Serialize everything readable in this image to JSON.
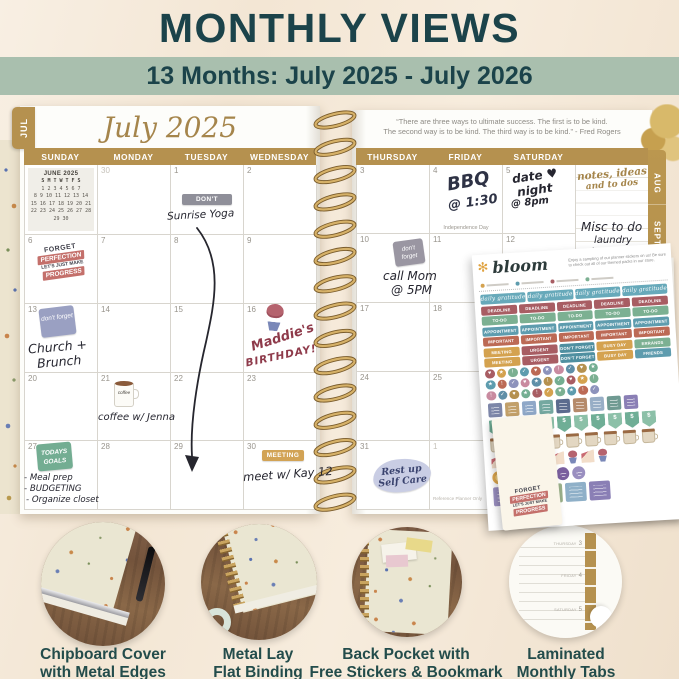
{
  "header": {
    "title": "MONTHLY VIEWS",
    "banner": "13 Months: July 2025 - July 2026"
  },
  "colors": {
    "heading_teal": "#1b434a",
    "banner_green": "#a9bfae",
    "planner_gold": "#b5914f"
  },
  "planner": {
    "month_tab": "JUL",
    "month_title": "July 2025",
    "quote_line1": "“There are three ways to ultimate success. The first is to be kind.",
    "quote_line2": "The second way is to be kind. The third way is to be kind.” - Fred Rogers",
    "weekdays_left": [
      "SUNDAY",
      "MONDAY",
      "TUESDAY",
      "WEDNESDAY"
    ],
    "weekdays_right": [
      "THURSDAY",
      "FRIDAY",
      "SATURDAY"
    ],
    "side_tabs": [
      "AUG",
      "SEPT",
      "OCT",
      "NOV"
    ],
    "mini_calendar": {
      "title": "JUNE 2025",
      "day_row": "S  M  T  W  T  F  S",
      "weeks": [
        "1  2  3  4  5  6  7",
        "8  9 10 11 12 13 14",
        "15 16 17 18 19 20 21",
        "22 23 24 25 26 27 28",
        "29 30"
      ]
    },
    "left_dates": [
      {
        "d": "",
        "mini": true
      },
      {
        "d": "30",
        "gray": true
      },
      {
        "d": "1"
      },
      {
        "d": "2"
      },
      {
        "d": "6"
      },
      {
        "d": "7"
      },
      {
        "d": "8"
      },
      {
        "d": "9"
      },
      {
        "d": "13"
      },
      {
        "d": "14"
      },
      {
        "d": "15"
      },
      {
        "d": "16"
      },
      {
        "d": "20"
      },
      {
        "d": "21"
      },
      {
        "d": "22"
      },
      {
        "d": "23"
      },
      {
        "d": "27"
      },
      {
        "d": "28"
      },
      {
        "d": "29"
      },
      {
        "d": "30"
      }
    ],
    "right_dates": [
      {
        "d": "3"
      },
      {
        "d": "4",
        "note": "Independence Day"
      },
      {
        "d": "5"
      },
      {
        "d": "10"
      },
      {
        "d": "11"
      },
      {
        "d": "12"
      },
      {
        "d": "17"
      },
      {
        "d": "18"
      },
      {
        "d": "19"
      },
      {
        "d": "24"
      },
      {
        "d": "25"
      },
      {
        "d": "26"
      },
      {
        "d": "31"
      },
      {
        "d": "1",
        "gray": true
      },
      {
        "d": ""
      }
    ],
    "entries": {
      "jul1_sticker": "DON'T FORGET",
      "jul1_note": "Sunrise Yoga",
      "jul4_note1": "BBQ",
      "jul4_note2": "@ 1:30",
      "jul5_note1": "date ♥",
      "jul5_note2": "night",
      "jul5_note3": "@ 8pm",
      "notes_header1": "notes, ideas",
      "notes_header2": "and to dos",
      "notes_misc1": "Misc to do",
      "notes_misc2": "laundry",
      "notes_misc3": "ironing",
      "jul10_sticker": "don't forget",
      "jul10_note1": "call Mom",
      "jul10_note2": "@ 5PM",
      "jul13_sticker": "don't forget",
      "jul13_note1": "Church +",
      "jul13_note2": "Brunch",
      "jul16_note1": "Maddie's",
      "jul16_note2": "BIRTHDAY!",
      "jul21_mug": "coffee",
      "jul21_note": "coffee w/ Jenna",
      "jul27_sticker1": "TODAYS",
      "jul27_sticker2": "GOALS",
      "jul27_list1": "- Meal prep",
      "jul27_list2": "- BUDGETING",
      "jul27_list3": "- Organize closet",
      "jul30_sticker": "MEETING",
      "jul30_note": "meet w/ Kay 12",
      "jul31_note1": "Rest up",
      "jul31_note2": "Self Care",
      "footnote": "Reference Planner Only"
    },
    "quote_sticker": {
      "line1": "FORGET",
      "line2": "PERFECTION",
      "line3": "LET'S JUST MAKE",
      "line4": "PROGRESS"
    }
  },
  "sticker_sheet": {
    "brand": "bloom",
    "brand_icon": "✻",
    "tagline1": "Enjoy a sampling of our planner stickers on us!",
    "tagline2": "Be sure to check out all of our themed packs in our store.",
    "label_rows": [
      {
        "script": true,
        "cells": [
          {
            "t": "daily gratitude",
            "c": "#67a9ba"
          },
          {
            "t": "daily gratitude",
            "c": "#67a9ba"
          },
          {
            "t": "daily gratitude",
            "c": "#67a9ba"
          },
          {
            "t": "daily gratitude",
            "c": "#67a9ba"
          }
        ]
      },
      {
        "cells": [
          {
            "t": "DEADLINE",
            "c": "#a85d63"
          },
          {
            "t": "DEADLINE",
            "c": "#a85d63"
          },
          {
            "t": "DEADLINE",
            "c": "#a85d63"
          },
          {
            "t": "DEADLINE",
            "c": "#a85d63"
          },
          {
            "t": "DEADLINE",
            "c": "#a85d63"
          }
        ]
      },
      {
        "cells": [
          {
            "t": "TO-DO",
            "c": "#7cb092"
          },
          {
            "t": "TO-DO",
            "c": "#7cb092"
          },
          {
            "t": "TO-DO",
            "c": "#7cb092"
          },
          {
            "t": "TO-DO",
            "c": "#7cb092"
          },
          {
            "t": "TO-DO",
            "c": "#7cb092"
          }
        ]
      },
      {
        "cells": [
          {
            "t": "APPOINTMENT",
            "c": "#5e9cae"
          },
          {
            "t": "APPOINTMENT",
            "c": "#5e9cae"
          },
          {
            "t": "APPOINTMENT",
            "c": "#5e9cae"
          },
          {
            "t": "APPOINTMENT",
            "c": "#5e9cae"
          },
          {
            "t": "APPOINTMENT",
            "c": "#5e9cae"
          }
        ]
      },
      {
        "cells": [
          {
            "t": "IMPORTANT",
            "c": "#bc6a55"
          },
          {
            "t": "IMPORTANT",
            "c": "#bc6a55"
          },
          {
            "t": "IMPORTANT",
            "c": "#bc6a55"
          },
          {
            "t": "IMPORTANT",
            "c": "#bc6a55"
          },
          {
            "t": "IMPORTANT",
            "c": "#bc6a55"
          }
        ]
      },
      {
        "cells": [
          {
            "t": "MEETING",
            "c": "#d4a24f"
          },
          {
            "t": "URGENT",
            "c": "#a85d63"
          },
          {
            "t": "DON'T FORGET",
            "c": "#4f8fa0"
          },
          {
            "t": "BUSY DAY",
            "c": "#d4a24f"
          },
          {
            "t": "ERRANDS",
            "c": "#7cb092"
          }
        ]
      },
      {
        "cells": [
          {
            "t": "MEETING",
            "c": "#d4a24f"
          },
          {
            "t": "URGENT",
            "c": "#a85d63"
          },
          {
            "t": "DON'T FORGET",
            "c": "#4f8fa0"
          },
          {
            "t": "BUSY DAY",
            "c": "#d4a24f"
          },
          {
            "t": "FRIENDS",
            "c": "#5e9cae"
          }
        ]
      }
    ],
    "dot_rows": 3,
    "dots_per_row": 10,
    "dot_glyphs": [
      "♥",
      "★",
      "!",
      "✓"
    ],
    "dot_colors": [
      "#a85d63",
      "#d4a24f",
      "#7cb092",
      "#5e9cae",
      "#bc6a55",
      "#8d93bc",
      "#c98ba0",
      "#5f8fa8",
      "#b5914f",
      "#74ae92"
    ],
    "square_colors": [
      "#7d86a8",
      "#c2a06a",
      "#8fa8c8",
      "#74a8a0",
      "#5b6b8e",
      "#b58a6a",
      "#98aec6",
      "#6f9a92",
      "#8a7fb5"
    ],
    "pennant_glyph": "$",
    "pennant_count": 10,
    "pennant_colors": [
      "#6fae96",
      "#8cc0a8"
    ],
    "cup_count": 9,
    "cake_count": 8,
    "art_circle_colors": [
      "#e0a94f",
      "#88a86a",
      "#5f8fa8",
      "#8a6fa8",
      "#7a5f9e",
      "#9a8fc0"
    ],
    "quote_square_colors": [
      "#9a8fc0",
      "#c2655f",
      "#9ab08a",
      "#8fb0c8",
      "#8a7fb5"
    ]
  },
  "tab_page": {
    "rows": [
      {
        "label": "THURSDAY",
        "num": "3"
      },
      {
        "label": "FRIDAY",
        "num": "4"
      },
      {
        "label": "SATURDAY",
        "num": "5"
      }
    ]
  },
  "features": [
    {
      "line1": "Chipboard Cover",
      "line2": "with Metal Edges"
    },
    {
      "line1": "Metal Lay",
      "line2": "Flat Binding"
    },
    {
      "line1": "Back Pocket with",
      "line2": "Free Stickers & Bookmark"
    },
    {
      "line1": "Laminated",
      "line2": "Monthly Tabs"
    }
  ]
}
